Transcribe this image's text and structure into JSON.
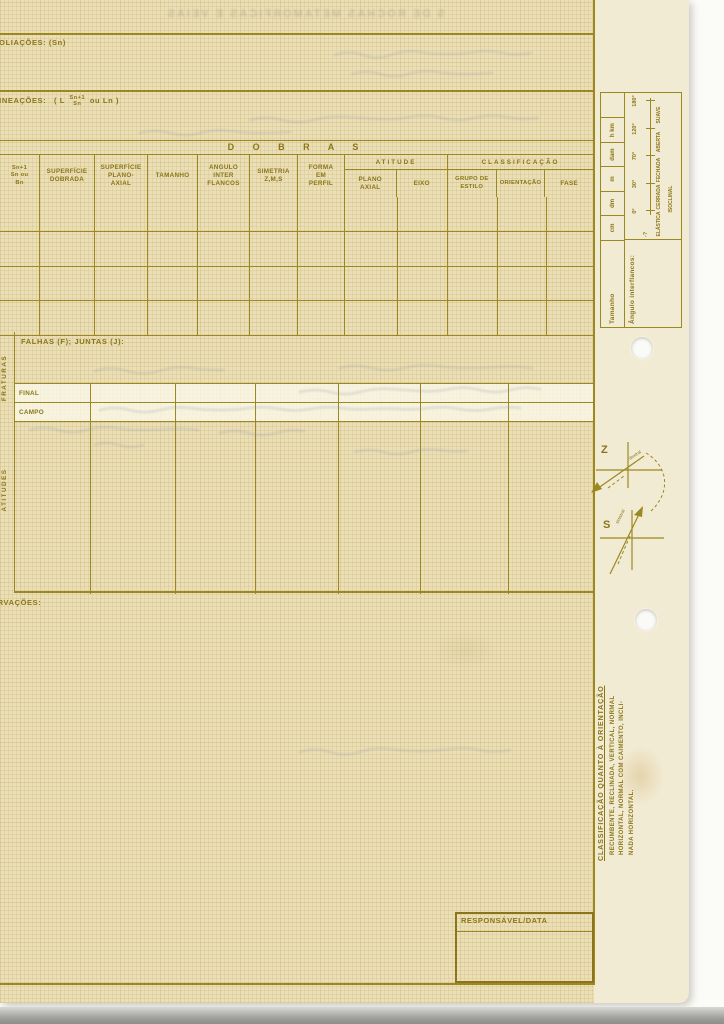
{
  "ghost": {
    "top_line": "S DE ROCHAS METAMORFICAS E VEIAS"
  },
  "sections": {
    "foliacoes": "FOLIAÇÕES: (Sn)",
    "lineacoes": "LINEAÇÕES:",
    "lineacoes_paren_open": "( L",
    "lineacoes_sup": "Sn+1",
    "lineacoes_sub": "Sn",
    "lineacoes_tail": "ou Ln )",
    "observacoes": "OBSERVAÇÕES:",
    "responsavel": "RESPONSÁVEL/DATA"
  },
  "dobras": {
    "title": "D O B R A S",
    "col_sn": "Sn+1\nSn ou\nBn",
    "col_superficie_dobrada": "SUPERFÍCIE\nDOBRADA",
    "col_superficie_plano_axial": "SUPERFÍCIE\nPLANO-\nAXIAL",
    "col_tamanho": "TAMANHO",
    "col_angulo": "ANGULO\nINTER\nFLANCOS",
    "col_simetria": "SIMETRIA\nZ,M,S",
    "col_forma": "FORMA\nEM\nPERFIL",
    "grp_atitude": "ATITUDE",
    "col_plano_axial": "PLANO\nAXIAL",
    "col_eixo": "EIXO",
    "grp_classificacao": "CLASSIFICAÇÃO",
    "col_grupo_estilo": "GRUPO DE\nESTILO",
    "col_orientacao": "ORIENTAÇÃO",
    "col_fase": "FASE"
  },
  "falhas": {
    "fraturas_label": "FRATURAS",
    "header": "FALHAS (F); JUNTAS (J):",
    "final_label": "FINAL",
    "campo_label": "CAMPO",
    "atitudes_label": "ATITUDES"
  },
  "scale_table": {
    "tamanho_label": "Tamanho",
    "units": [
      "cm",
      "dm",
      "m",
      "dam",
      "h km",
      ""
    ],
    "angulo_label": "Ângulo interflancos:",
    "prefix": "-?",
    "ticks": [
      "0°",
      "30°",
      "70°",
      "120°",
      "180°"
    ],
    "classes": [
      "ELÁSTICA",
      "CERRADA",
      "FECHADA",
      "ABERTA",
      "SUAVE"
    ],
    "isoclinal": "ISOCLINAL"
  },
  "symbols": {
    "z": "Z",
    "s": "S",
    "z_note": "dextral",
    "s_note": "sinistral"
  },
  "classification": {
    "heading": "CLASSIFICAÇÃO QUANTO À ORIENTAÇÃO",
    "line1": "RECUMBENTE, RECLINADA, VERTICAL, NORMAL",
    "line2": "HORIZONTAL, NORMAL COM CAIMENTO, INCLI-",
    "line3": "NADA HORIZONTAL."
  }
}
